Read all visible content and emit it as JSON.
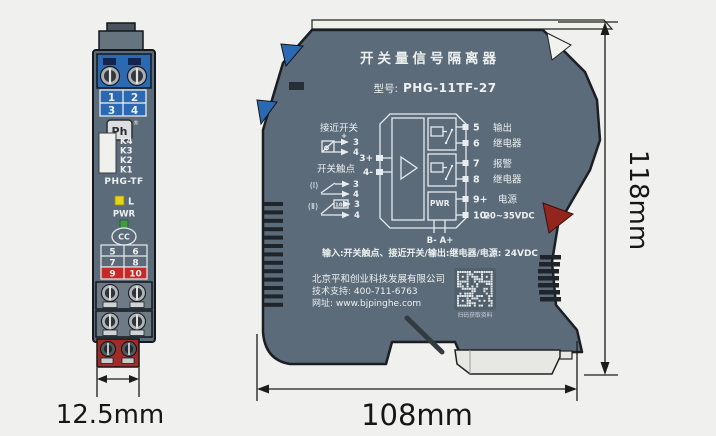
{
  "side_module": {
    "terminal_table_top": [
      "1",
      "2",
      "3",
      "4"
    ],
    "brand_logo": "Ph",
    "registered_mark": "®",
    "k_labels": [
      "K4",
      "K3",
      "K2",
      "K1"
    ],
    "model": "PHG-TF",
    "led_label": "L",
    "power_label": "PWR",
    "cert_mark": "CC",
    "terminal_table_mid": [
      "5",
      "6",
      "7",
      "8"
    ],
    "terminal_table_alarm": [
      "9",
      "10"
    ]
  },
  "front_module": {
    "title": "开关量信号隔离器",
    "model_prefix": "型号:",
    "model": "PHG-11TF-27",
    "diagram": {
      "proximity_label": "接近开关",
      "plus_sign": "+",
      "contact_label": "开关触点",
      "contact1_numeral": "(Ⅰ)",
      "contact2_numeral": "(Ⅱ)",
      "resistor_value": "10K",
      "term3": "3",
      "term4": "4",
      "input_plus": "3+",
      "input_minus": "4-",
      "pwr_box_label": "PWR",
      "bus_label": "B- A+",
      "term5": "5",
      "term6": "6",
      "term7": "7",
      "term8": "8",
      "term9": "9+",
      "term10": "10-",
      "output_relay_line1": "输出",
      "output_relay_line2": "继电器",
      "alarm_relay_line1": "报警",
      "alarm_relay_line2": "继电器",
      "power_line1": "电源",
      "power_line2": "20~35VDC"
    },
    "spec_line": "输入:开关触点、接近开关/输出:继电器/电源: 24VDC",
    "company_name": "北京平和创业科技发展有限公司",
    "support_line": "技术支持: 400-711-6763",
    "website_line": "网址: www.bjpinghe.com",
    "qr_caption": "扫码获取资料"
  },
  "dimensions": {
    "side_width": "12.5mm",
    "front_width": "108mm",
    "height": "118mm"
  },
  "colors": {
    "module_body": "#5b6b7a",
    "terminal_blue": "#2b6ab3",
    "terminal_red": "#a82a28",
    "led_yellow": "#e5d41e",
    "led_green": "#3f9a42",
    "background": "#f0f0ee"
  }
}
